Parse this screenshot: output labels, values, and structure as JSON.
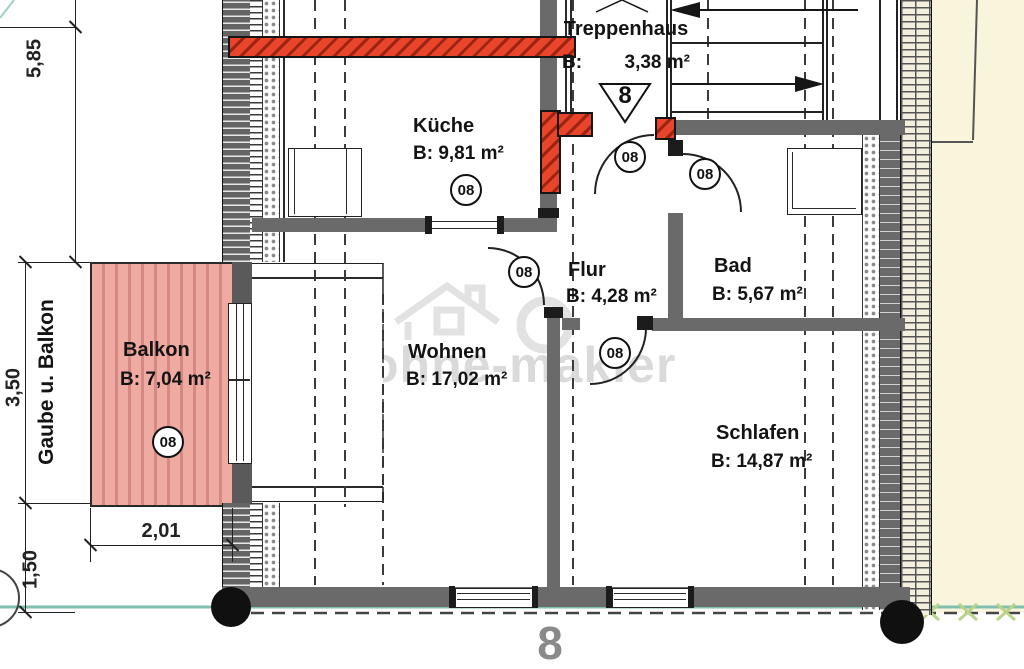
{
  "plan": {
    "watermark_text": "ohne-makler",
    "door_badge": "08",
    "stair_direction_number": "8",
    "sheet_number": "8"
  },
  "rooms": {
    "treppenhaus": {
      "name": "Treppenhaus",
      "area_prefix": "B:",
      "area_value": "3,38 m²"
    },
    "kueche": {
      "name": "Küche",
      "area": "B: 9,81 m²"
    },
    "flur": {
      "name": "Flur",
      "area": "B: 4,28 m²"
    },
    "bad": {
      "name": "Bad",
      "area": "B: 5,67 m²"
    },
    "wohnen": {
      "name": "Wohnen",
      "area": "B: 17,02 m²"
    },
    "schlafen": {
      "name": "Schlafen",
      "area": "B: 14,87 m²"
    },
    "balkon": {
      "name": "Balkon",
      "area": "B: 7,04 m²"
    }
  },
  "dimensions": {
    "left_upper": "5,85",
    "left_middle": "3,50",
    "left_lower": "1,50",
    "balcony_width": "2,01",
    "side_label": "Gaube u. Balkon"
  },
  "colors": {
    "wall_gray": "#6a6a6a",
    "accent_red": "#e8452a",
    "balcony_pink": "#efaaa2",
    "site_beige": "#f8f5dc",
    "boundary_teal": "#7fbfae",
    "marker_green": "#b9d489"
  }
}
